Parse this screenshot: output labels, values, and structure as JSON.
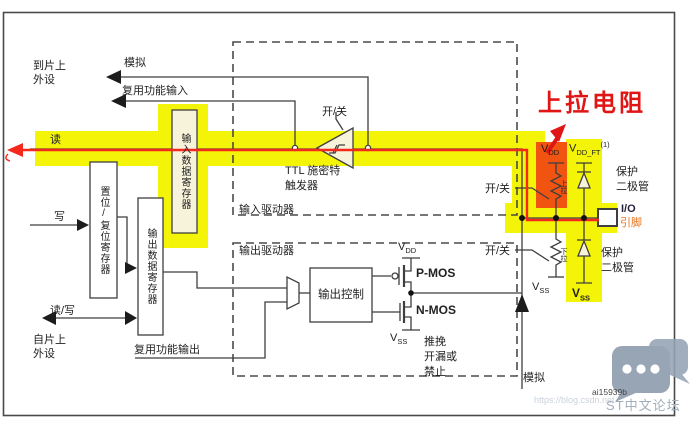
{
  "title": "STM32 GPIO port bit basic structure diagram (Chinese)",
  "colors": {
    "highlight_yellow": "#f3f407",
    "pullup_orange": "#f05410",
    "path_red": "#f5281c",
    "annotation_red": "#e01616",
    "wire": "#3f3f3f",
    "box_beige": "#f7f3da",
    "pin_label_orange": "#e8731c",
    "watermark_gray": "#8a99ab"
  },
  "labels": {
    "to_periph_1": "到片上",
    "to_periph_2": "外设",
    "analog": "模拟",
    "af_input": "复用功能输入",
    "read": "读",
    "write": "写",
    "read_write": "读/写",
    "from_periph_1": "自片上",
    "from_periph_2": "外设",
    "reg_input": "输入数据寄存器",
    "reg_bitset": "置位/复位寄存器",
    "reg_output": "输出数据寄存器",
    "input_driver": "输入驱动器",
    "output_driver": "输出驱动器",
    "on_off": "开/关",
    "ttl_1": "TTL 施密特",
    "ttl_2": "触发器",
    "output_control": "输出控制",
    "pmos": "P-MOS",
    "nmos": "N-MOS",
    "v": "V",
    "dd": "DD",
    "ss": "SS",
    "dd_ft": "DD_FT",
    "ft_note": "(1)",
    "push_pull_1": "推挽",
    "push_pull_2": "开漏或",
    "push_pull_3": "禁止",
    "af_output": "复用功能输出",
    "pull_up": "上拉",
    "pull_down": "下拉",
    "protect_1": "保护",
    "protect_2": "二极管",
    "io_1": "I/O",
    "io_2": "引脚",
    "pullup_annotation": "上拉电阻",
    "figure_id": "ai15939b"
  },
  "watermark": {
    "forum": "ST中文论坛",
    "url": "https://blog.csdn.net",
    "logo": "csdn-chat-bubbles-logo"
  }
}
